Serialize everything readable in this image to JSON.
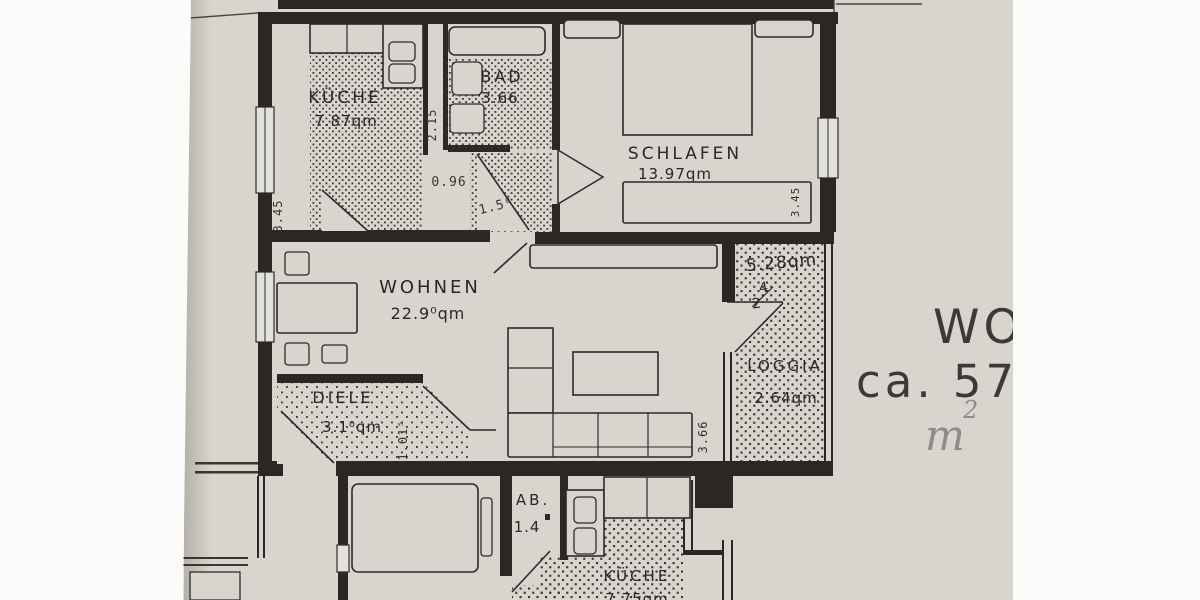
{
  "colors": {
    "paper": "#d8d5cf",
    "ink": "#2b2824",
    "pencil": "#8f8c88"
  },
  "rooms": {
    "kueche": {
      "name": "KÜCHE",
      "area": "7.87qm"
    },
    "bad": {
      "name": "BAD",
      "area": "3.66"
    },
    "schlafen": {
      "name": "SCHLAFEN",
      "area": "13.97qm"
    },
    "wohnen": {
      "name": "WOHNEN",
      "area": "22.9⁰qm"
    },
    "diele": {
      "name": "DIELE",
      "area": "3.1⁰qm"
    },
    "loggia": {
      "name": "LOGGIA",
      "area": "2.64qm"
    },
    "loggia_upper": {
      "area": "5.28qm"
    },
    "ab": {
      "name": "AB.",
      "area": "1.4"
    },
    "kueche_lower": {
      "name": "KÜCHE",
      "area": "7.75qm"
    }
  },
  "dimensions": {
    "kueche_left_wall": "3.45",
    "niche_depth": "2.15",
    "flur_width": "0.96",
    "flur_door_width": "1.5⁰",
    "schlafen_right_wall": "3.45",
    "diele_width": "1.01⁵",
    "loggia_depth": "3.66"
  },
  "handwriting": {
    "line1": "WO",
    "line2": "ca. 57",
    "unit_base": "m",
    "unit_exponent": "2",
    "correction_top": "4",
    "correction_bottom": "2"
  }
}
